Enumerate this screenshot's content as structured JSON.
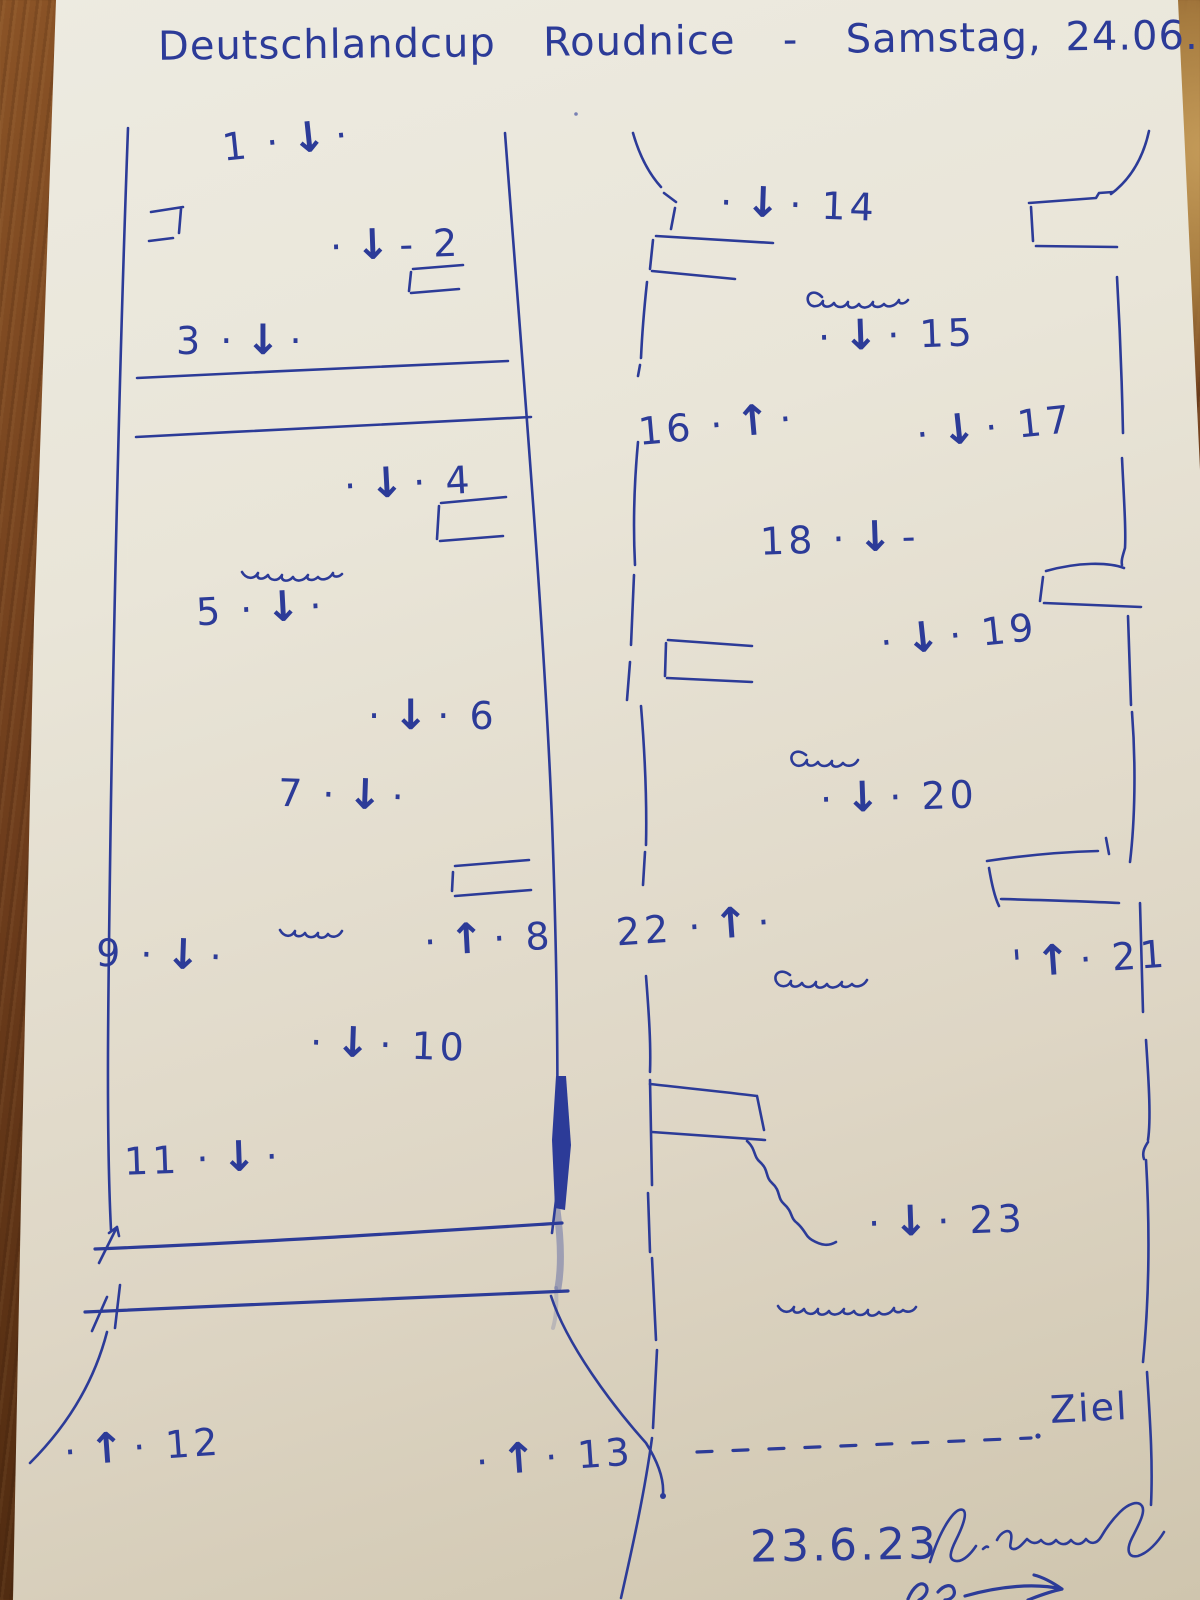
{
  "colors": {
    "ink": "#2c3b98",
    "paper_light": "#edebe1",
    "paper_dark": "#cfc5ae"
  },
  "header": {
    "title": "Deutschlandcup  Roudnice  -  Samstag, 24.06.23"
  },
  "course": {
    "finish_label": "Ziel",
    "plan_date": "23.6.23",
    "gates": [
      {
        "number": 1,
        "direction": "downstream",
        "prefix": "1 ·",
        "suffix": "·",
        "x": 222,
        "y": 120,
        "rot": -6
      },
      {
        "number": 2,
        "direction": "downstream",
        "prefix": "·",
        "suffix": "- 2",
        "x": 330,
        "y": 224,
        "rot": -2
      },
      {
        "number": 3,
        "direction": "downstream",
        "prefix": "3 ·",
        "suffix": "·",
        "x": 176,
        "y": 320,
        "rot": 0
      },
      {
        "number": 4,
        "direction": "downstream",
        "prefix": "·",
        "suffix": "· 4",
        "x": 344,
        "y": 462,
        "rot": -3
      },
      {
        "number": 5,
        "direction": "downstream",
        "prefix": "5 ·",
        "suffix": "·",
        "x": 196,
        "y": 588,
        "rot": -3
      },
      {
        "number": 6,
        "direction": "downstream",
        "prefix": "·",
        "suffix": "· 6",
        "x": 368,
        "y": 695,
        "rot": 0
      },
      {
        "number": 7,
        "direction": "downstream",
        "prefix": "7 ·",
        "suffix": "·",
        "x": 278,
        "y": 774,
        "rot": 2
      },
      {
        "number": 8,
        "direction": "upstream",
        "prefix": "·",
        "suffix": "· 8",
        "x": 424,
        "y": 918,
        "rot": -3
      },
      {
        "number": 9,
        "direction": "downstream",
        "prefix": "9 ·",
        "suffix": "·",
        "x": 96,
        "y": 934,
        "rot": 2
      },
      {
        "number": 10,
        "direction": "downstream",
        "prefix": "·",
        "suffix": "· 10",
        "x": 310,
        "y": 1024,
        "rot": 2
      },
      {
        "number": 11,
        "direction": "downstream",
        "prefix": "11 ·",
        "suffix": "·",
        "x": 124,
        "y": 1138,
        "rot": -2
      },
      {
        "number": 12,
        "direction": "upstream",
        "prefix": "·",
        "suffix": "· 12",
        "x": 64,
        "y": 1426,
        "rot": -4
      },
      {
        "number": 13,
        "direction": "upstream",
        "prefix": "·",
        "suffix": "· 13",
        "x": 476,
        "y": 1436,
        "rot": -4
      },
      {
        "number": 14,
        "direction": "downstream",
        "prefix": "·",
        "suffix": "· 14",
        "x": 720,
        "y": 184,
        "rot": 2
      },
      {
        "number": 15,
        "direction": "downstream",
        "prefix": "·",
        "suffix": "· 15",
        "x": 818,
        "y": 314,
        "rot": -2
      },
      {
        "number": 16,
        "direction": "upstream",
        "prefix": "16 ·",
        "suffix": "·",
        "x": 638,
        "y": 404,
        "rot": -5
      },
      {
        "number": 17,
        "direction": "downstream",
        "prefix": "·",
        "suffix": "· 17",
        "x": 916,
        "y": 406,
        "rot": -6
      },
      {
        "number": 18,
        "direction": "downstream",
        "prefix": "18 ·",
        "suffix": "-",
        "x": 760,
        "y": 518,
        "rot": -2
      },
      {
        "number": 19,
        "direction": "downstream",
        "prefix": "·",
        "suffix": "· 19",
        "x": 880,
        "y": 614,
        "rot": -6
      },
      {
        "number": 20,
        "direction": "downstream",
        "prefix": "·",
        "suffix": "· 20",
        "x": 820,
        "y": 776,
        "rot": -2
      },
      {
        "number": 21,
        "direction": "upstream",
        "prefix": "'",
        "suffix": "· 21",
        "x": 1012,
        "y": 938,
        "rot": -4
      },
      {
        "number": 22,
        "direction": "upstream",
        "prefix": "22 ·",
        "suffix": "·",
        "x": 616,
        "y": 906,
        "rot": -4
      },
      {
        "number": 23,
        "direction": "downstream",
        "prefix": "·",
        "suffix": "· 23",
        "x": 868,
        "y": 1200,
        "rot": -2
      }
    ]
  },
  "icons": {
    "down_arrow": "↓",
    "up_arrow": "↑"
  }
}
